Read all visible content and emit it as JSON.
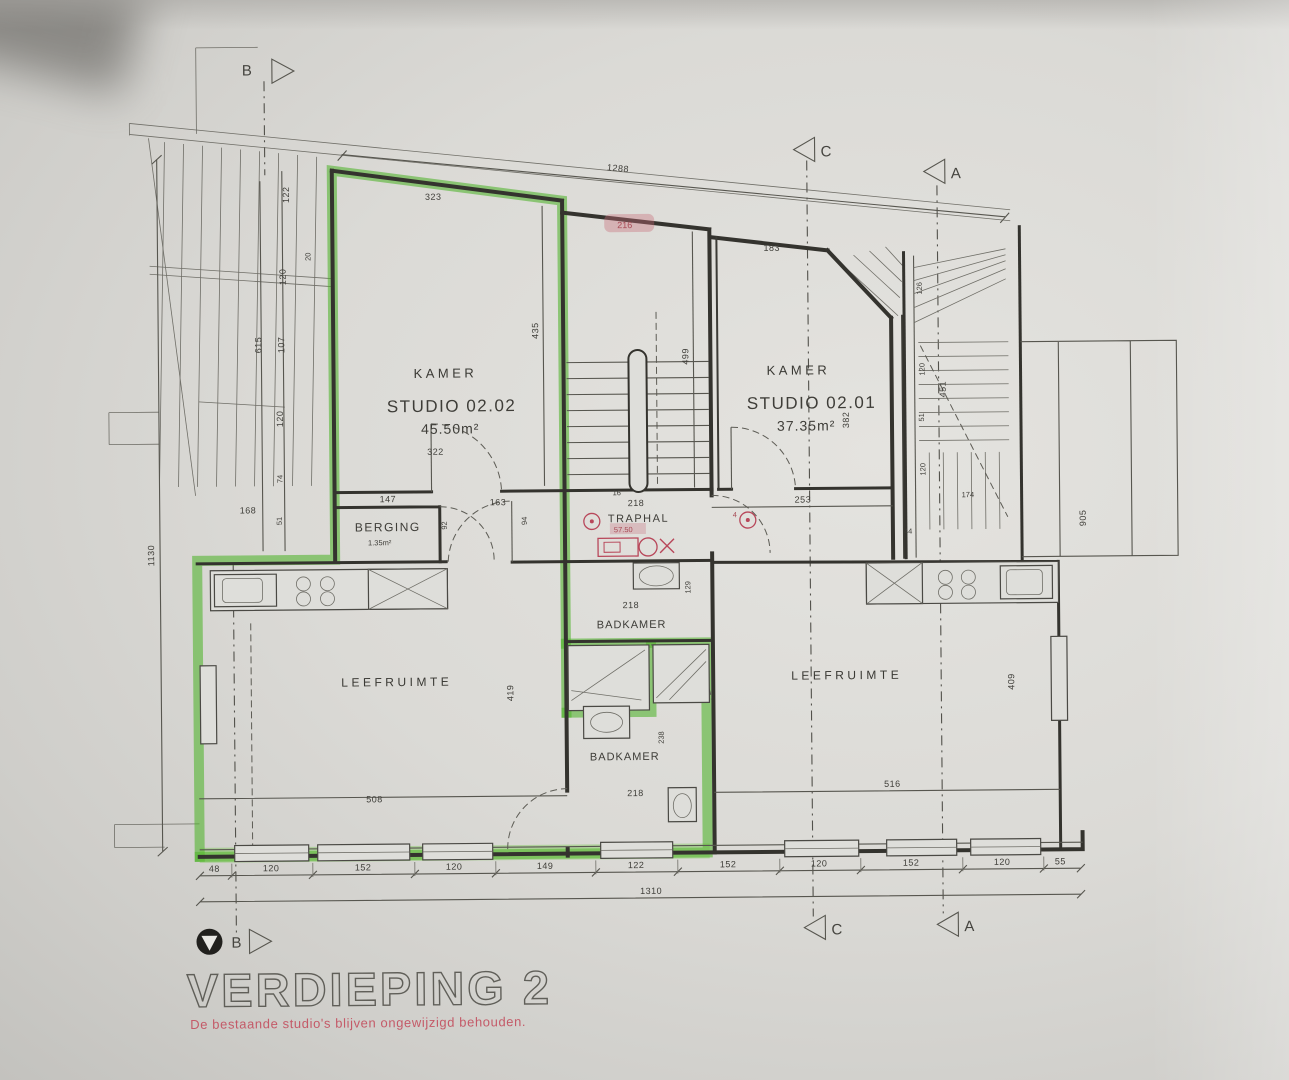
{
  "title": {
    "main": "VERDIEPING 2",
    "subtitle": "De bestaande studio's blijven ongewijzigd behouden."
  },
  "rooms": {
    "kamer_left": {
      "label": "KAMER",
      "studio": "STUDIO 02.02",
      "area": "45.50m²"
    },
    "kamer_right": {
      "label": "KAMER",
      "studio": "STUDIO 02.01",
      "area": "37.35m²"
    },
    "berging": {
      "label": "BERGING",
      "area": "1.35m²"
    },
    "traphal": {
      "label": "TRAPHAL"
    },
    "badkamer_top": {
      "label": "BADKAMER"
    },
    "badkamer_bottom": {
      "label": "BADKAMER"
    },
    "leefruimte_left": {
      "label": "LEEFRUIMTE"
    },
    "leefruimte_right": {
      "label": "LEEFRUIMTE"
    }
  },
  "markers": {
    "a": "A",
    "b": "B",
    "c": "C"
  },
  "annotations": {
    "stamp": "216",
    "traphal_note": "57.50",
    "detector_count": "4"
  },
  "dims": {
    "top_total": "1288",
    "bottom": [
      "48",
      "120",
      "152",
      "120",
      "149",
      "122",
      "152",
      "120",
      "152",
      "120",
      "55"
    ],
    "bottom_total": "1310",
    "left_1130": "1130",
    "left_615": "615",
    "left_107": "107",
    "left_122": "122",
    "left_20": "20",
    "left_120a": "120",
    "left_120b": "120",
    "left_74": "74",
    "left_168": "168",
    "left_51": "51",
    "k2_top": "323",
    "k2_right": "435",
    "k2_bottom": "322",
    "k1_top": "183",
    "k1_right": "382",
    "k1_hall": "253",
    "berging_top": "147",
    "berging_right": "92",
    "hall_163": "163",
    "hall_94": "94",
    "hall_16": "16",
    "stair_499": "499",
    "stair_218": "218",
    "bk1_218": "218",
    "bk1_129": "129",
    "bk2_218": "218",
    "bk2_238": "238",
    "lr_left_508": "508",
    "lr_left_419": "419",
    "lr_right_516": "516",
    "lr_right_409": "409",
    "rs_126": "126",
    "rs_120a": "120",
    "rs_451": "451",
    "rs_51": "51",
    "rs_120b": "120",
    "rs_174": "174",
    "rs_44": "44",
    "rs_905": "905"
  },
  "colors": {
    "highlight_green": "#4fb32b",
    "annotation_red": "#b8475a",
    "line": "#34332e",
    "paper": "#dbdad6"
  }
}
